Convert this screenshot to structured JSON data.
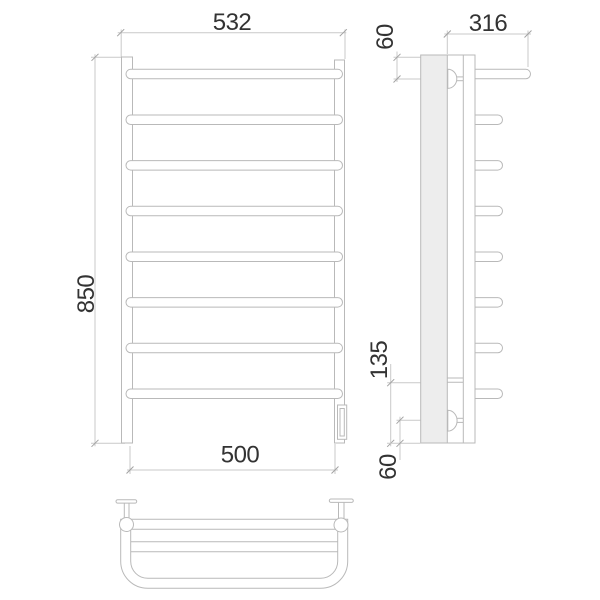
{
  "drawing": {
    "front_view": {
      "width_top_mm": "532",
      "height_mm": "850",
      "width_bottom_mm": "500",
      "rung_count": 8
    },
    "side_view": {
      "depth_mm": "316",
      "top_offset_mm": "60",
      "lower_connection_mm": "135",
      "bottom_offset_mm": "60",
      "rung_count": 8,
      "has_wall_section": true
    },
    "top_view": {
      "bracket_count": 2
    }
  },
  "colors": {
    "line-color": "#b9b9b9",
    "dim-color": "#c9c9c9",
    "tick-color": "#a2a2a2",
    "text-color": "#333333",
    "wall-fill": "#ededed",
    "bg-color": "#ffffff"
  }
}
